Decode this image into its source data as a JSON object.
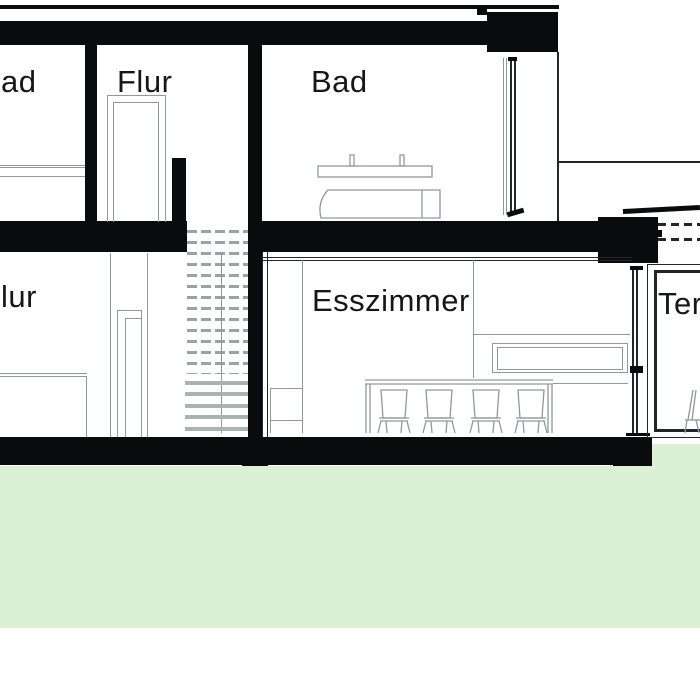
{
  "drawing": {
    "kind": "building-section-drawing",
    "labels": {
      "upper_left_room": "ad",
      "upper_hall": "Flur",
      "upper_bath": "Bad",
      "lower_hall": "lur",
      "dining_room": "Esszimmer",
      "terrace": "Ter"
    }
  },
  "colors": {
    "wall": "#0a0b0c",
    "line_gray": "#8f999d",
    "line_dark": "#20262c",
    "hatch": "#98a3a6",
    "tread": "#a9b3b0",
    "green": "#dcf0d3",
    "text": "#161616"
  }
}
